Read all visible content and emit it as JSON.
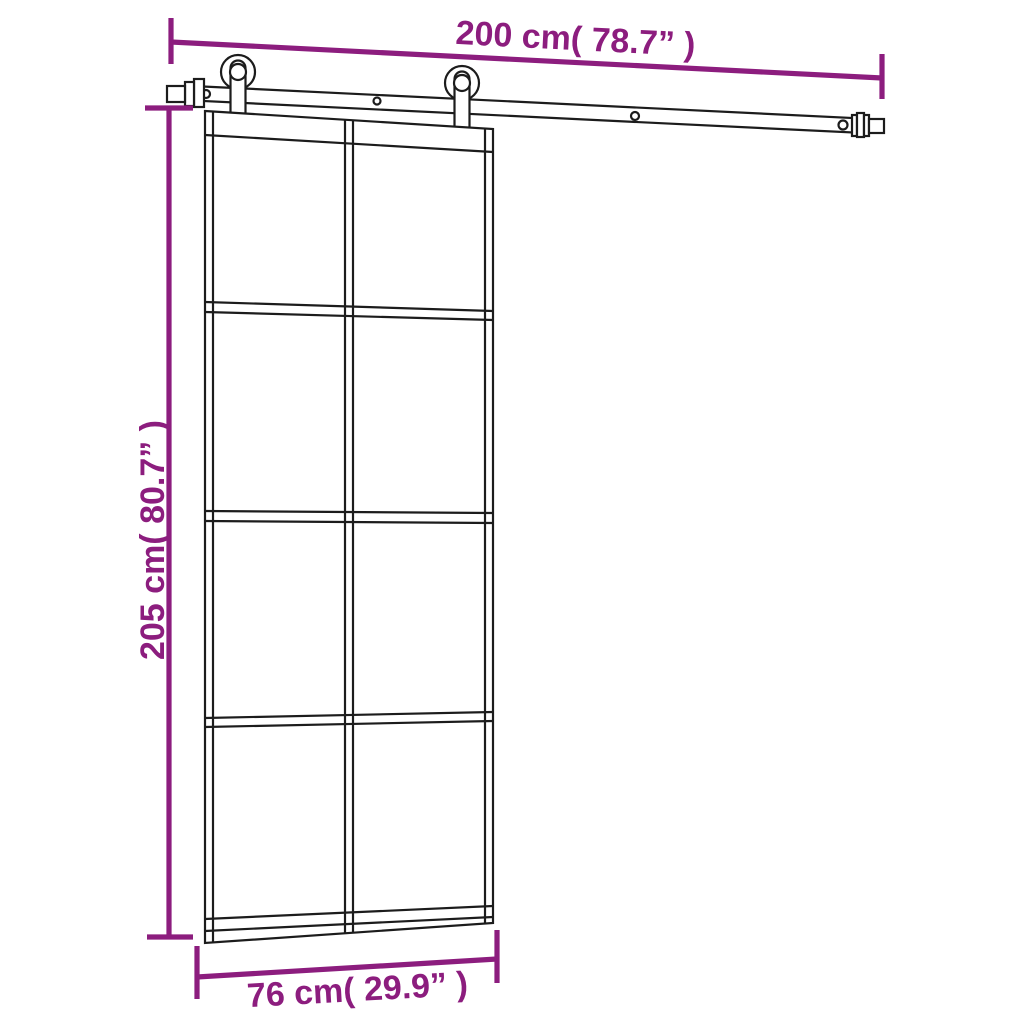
{
  "colors": {
    "dimension_annotation": "#8C1D7E",
    "drawing_line": "#1C1C1C",
    "background": "#FFFFFF"
  },
  "dimensions": {
    "rail_width_label": "200 cm( 78.7” )",
    "door_height_label": "205 cm( 80.7” )",
    "door_width_label": "76 cm( 29.9” )"
  },
  "door": {
    "pane_columns": 2,
    "pane_rows": 4,
    "pane_count": 8
  },
  "hardware": {
    "rollers": 2,
    "visible_screw_holes": 4,
    "end_stops": 2
  }
}
